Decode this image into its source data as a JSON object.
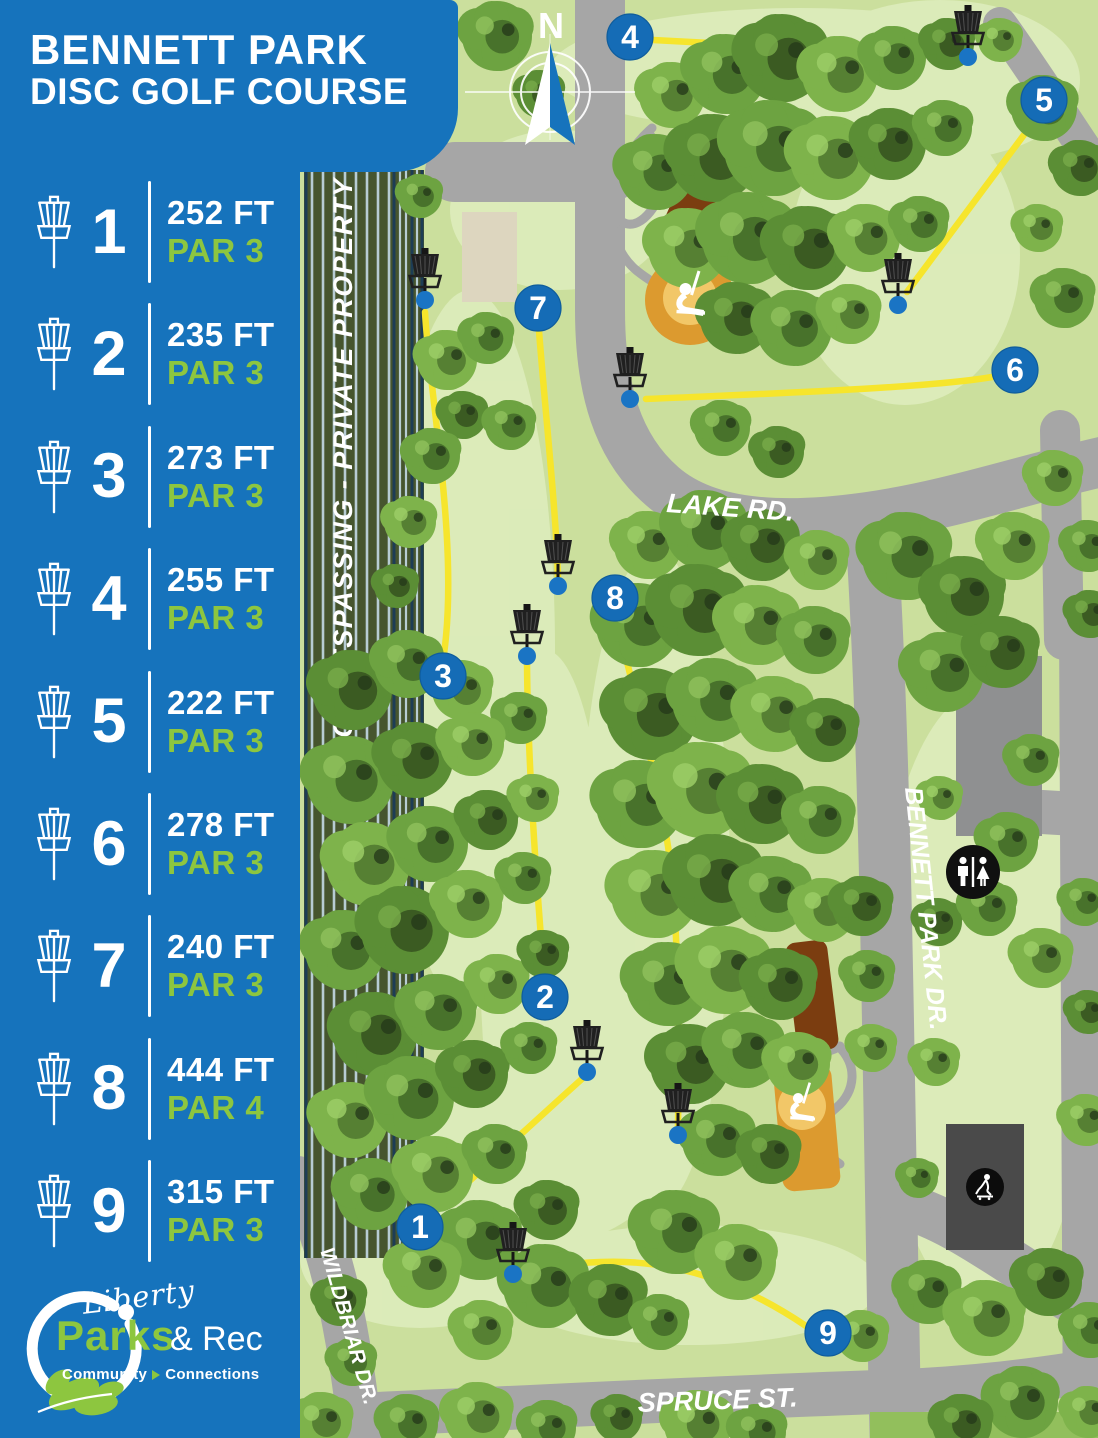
{
  "title": {
    "line1": "BENNETT PARK",
    "line2": "DISC GOLF COURSE"
  },
  "holes": [
    {
      "number": "1",
      "distance": "252 FT",
      "par": "PAR 3"
    },
    {
      "number": "2",
      "distance": "235 FT",
      "par": "PAR 3"
    },
    {
      "number": "3",
      "distance": "273 FT",
      "par": "PAR 3"
    },
    {
      "number": "4",
      "distance": "255 FT",
      "par": "PAR 3"
    },
    {
      "number": "5",
      "distance": "222 FT",
      "par": "PAR 3"
    },
    {
      "number": "6",
      "distance": "278 FT",
      "par": "PAR 3"
    },
    {
      "number": "7",
      "distance": "240 FT",
      "par": "PAR 3"
    },
    {
      "number": "8",
      "distance": "444 FT",
      "par": "PAR 4"
    },
    {
      "number": "9",
      "distance": "315 FT",
      "par": "PAR 3"
    }
  ],
  "map": {
    "compass": "N",
    "boundary_text": "NO TRESPASSING - PRIVATE PROPERTY",
    "labels": {
      "lake_rd": "LAKE RD.",
      "bennett_park_dr": "BENNETT PARK DR.",
      "wildbriar_dr": "WILDBRIAR DR.",
      "spruce_st": "SPRUCE ST."
    }
  },
  "logo": {
    "script": "Liberty",
    "word1": "Parks",
    "word2": "& Rec",
    "tagline_word1": "Community",
    "tagline_word2": "Connections"
  },
  "colors": {
    "sidebar_blue": "#1673bc",
    "marker_blue": "#156cb6",
    "par_green": "#8dc63f",
    "fairway_yellow": "#f6e52c",
    "road_gray": "#a6a6a6"
  }
}
